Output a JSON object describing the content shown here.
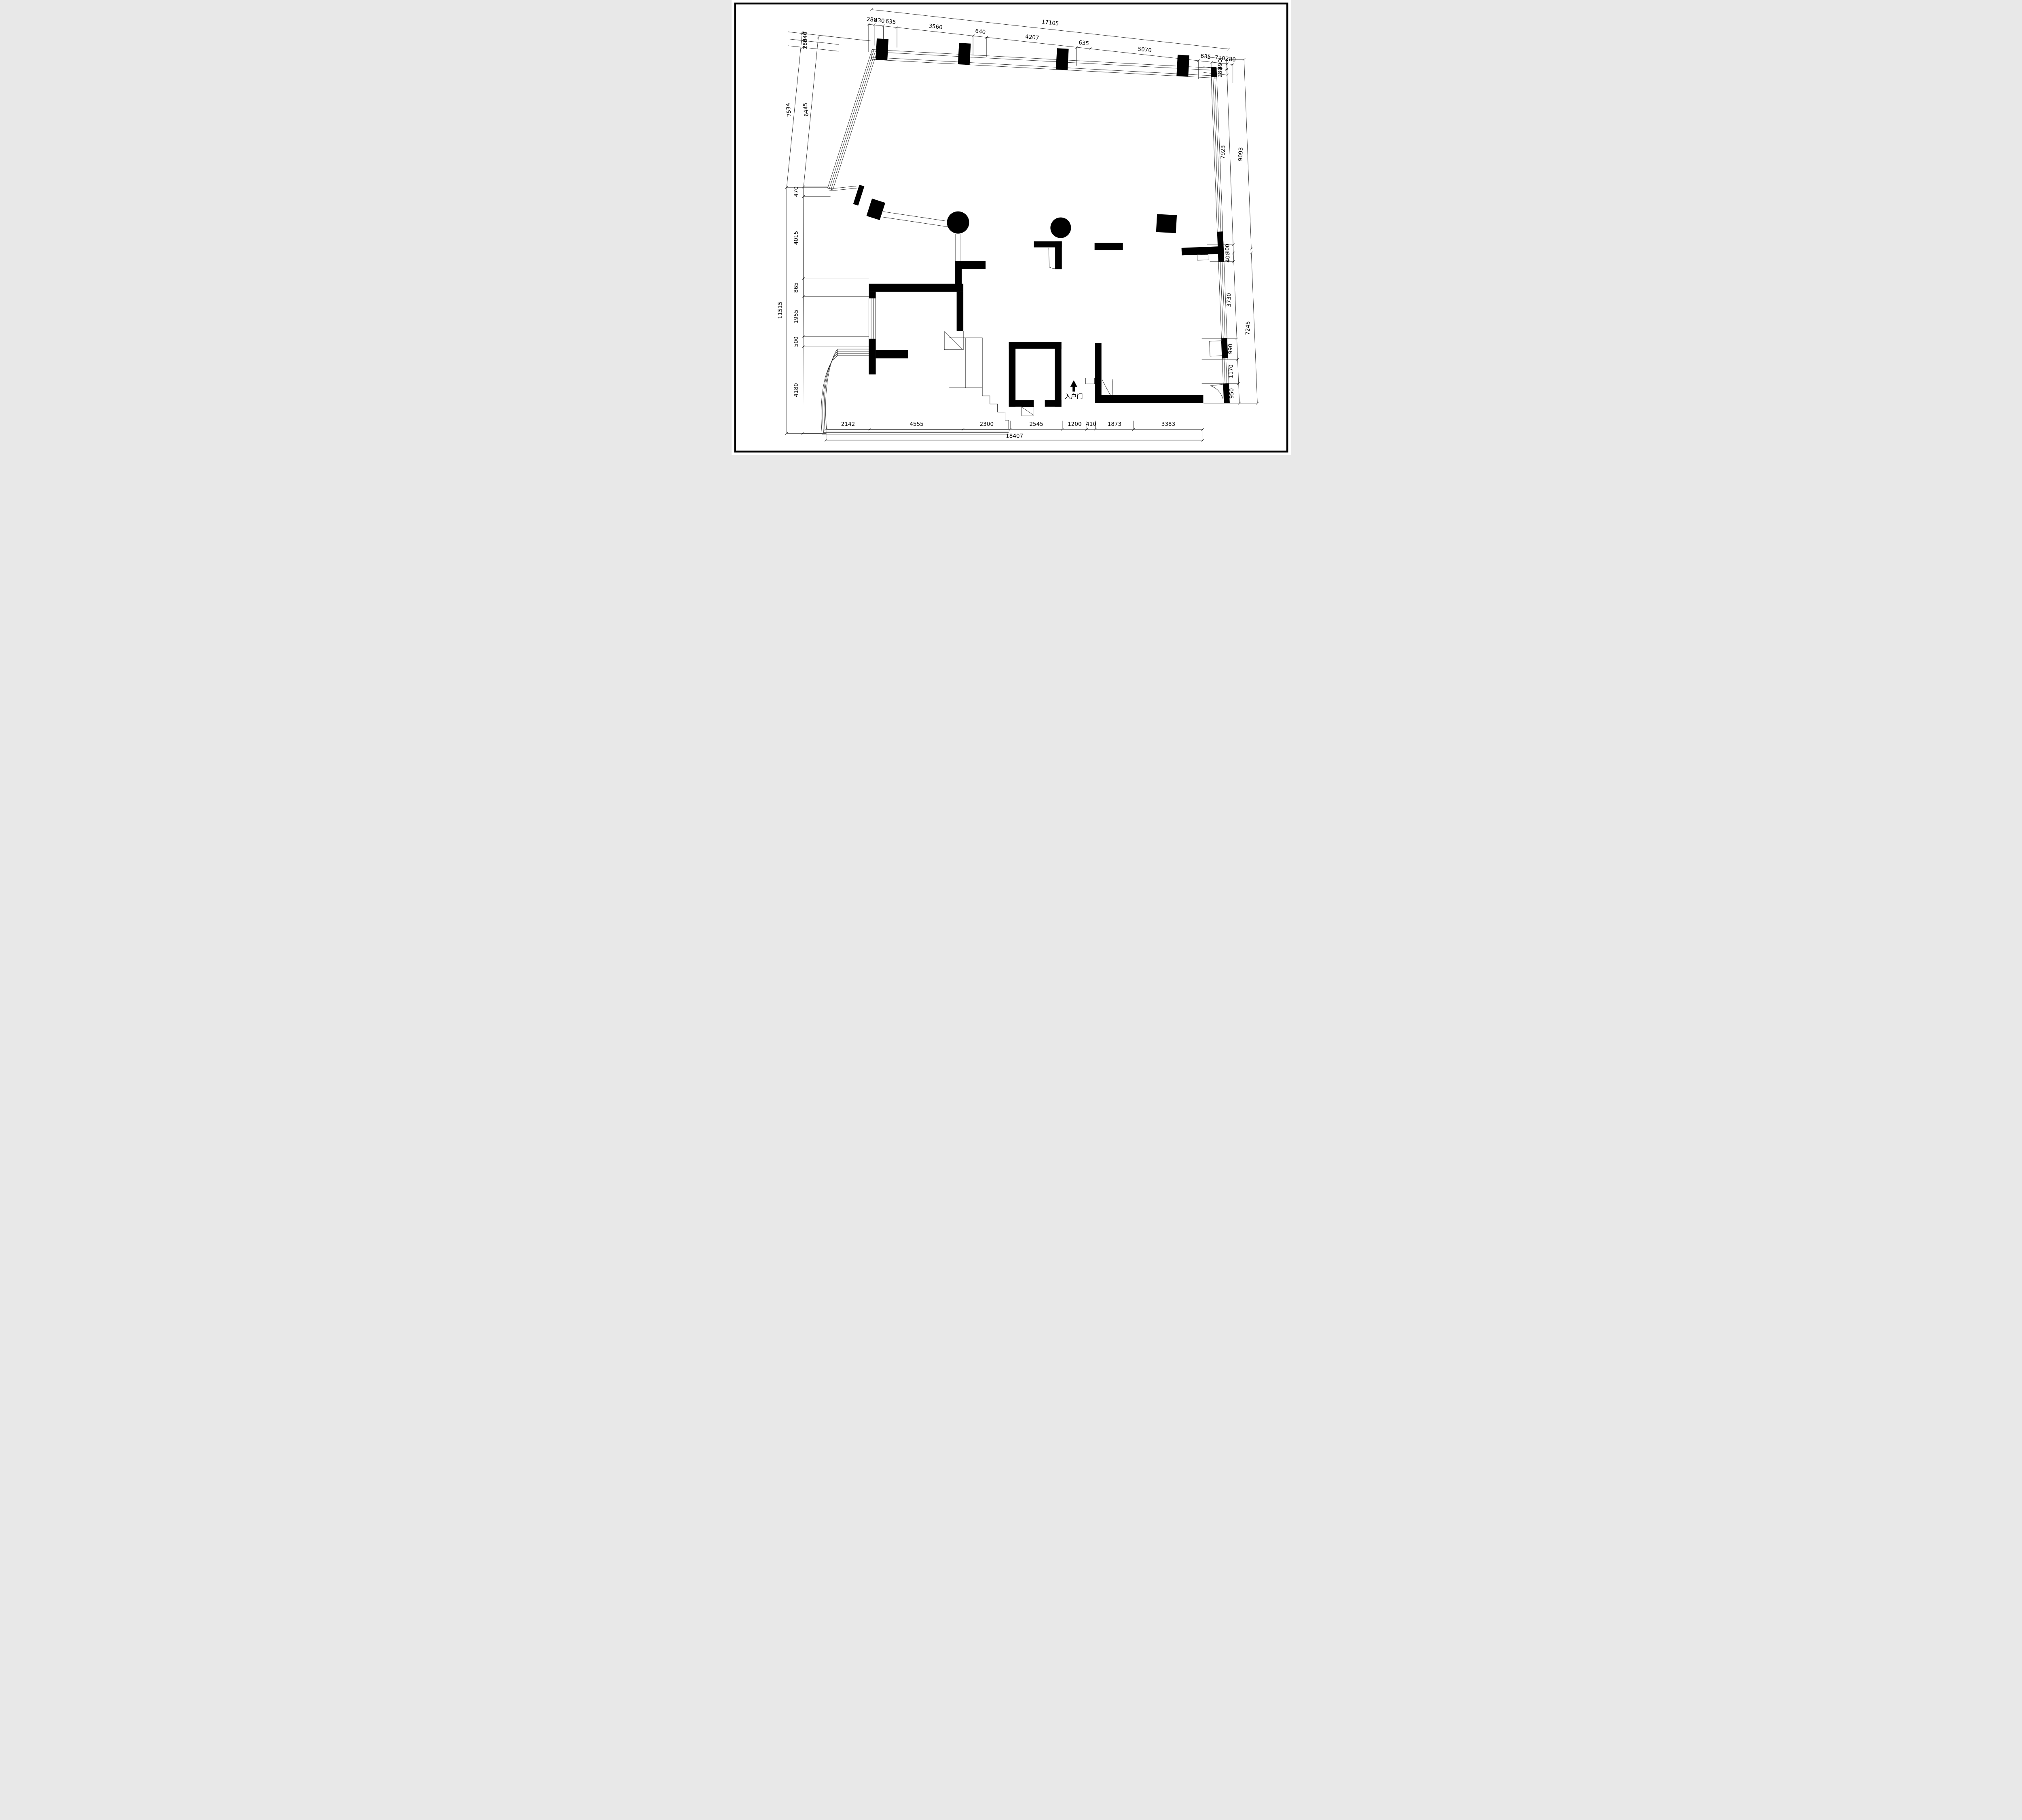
{
  "drawing": {
    "type": "floor-plan",
    "bg_color": "#ffffff",
    "line_color": "#000000"
  },
  "entrance": {
    "label": "入户门"
  },
  "dims": {
    "top": {
      "overall": "17105",
      "chain": [
        "280",
        "430",
        "635",
        "3560",
        "640",
        "4207",
        "635",
        "5070",
        "635",
        "710",
        "280"
      ]
    },
    "left": {
      "small": [
        "340",
        "280"
      ],
      "upper_outer": "7534",
      "upper_inner": "6445",
      "outer": "11515",
      "chain": [
        "470",
        "4015",
        "865",
        "1955",
        "500",
        "4180"
      ]
    },
    "right": {
      "small": [
        "490",
        "280"
      ],
      "upper_inner": "7923",
      "upper_outer": "9093",
      "lower_outer": "7245",
      "chain": [
        "400",
        "400",
        "3730",
        "990",
        "1170",
        "950"
      ]
    },
    "bottom": {
      "overall": "18407",
      "chain": [
        "2142",
        "4555",
        "2300",
        "2545",
        "1200",
        "410",
        "1873",
        "3383"
      ]
    }
  }
}
